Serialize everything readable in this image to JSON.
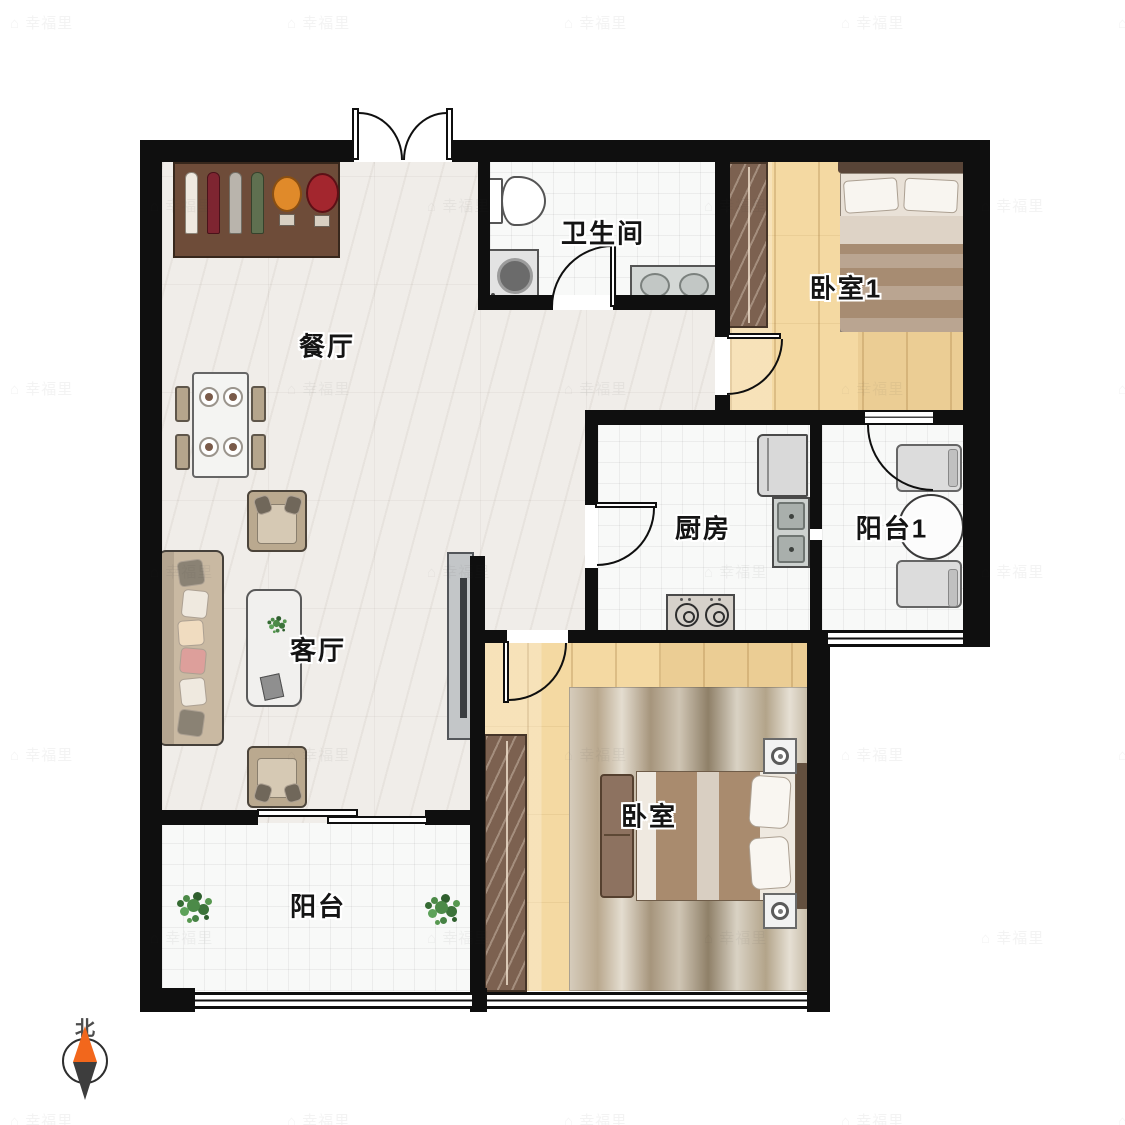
{
  "rooms": {
    "dining": {
      "label": "餐厅"
    },
    "bathroom": {
      "label": "卫生间"
    },
    "bedroom1": {
      "label": "卧室1"
    },
    "kitchen": {
      "label": "厨房"
    },
    "balcony1": {
      "label": "阳台1"
    },
    "living": {
      "label": "客厅"
    },
    "bedroom": {
      "label": "卧室"
    },
    "balcony": {
      "label": "阳台"
    }
  },
  "compass": {
    "label": "北"
  },
  "watermark": {
    "text": "幸福里",
    "glyph": "⌂"
  },
  "colors": {
    "wall": "#0f0f0f",
    "wood_floor": "#f4d9a2",
    "marble_floor": "#f0ede9",
    "tile_floor": "#f8f9f8",
    "wardrobe_brown": "#7c6150",
    "compass_north": "#f2671c",
    "plant_green": "#4c8a48"
  }
}
